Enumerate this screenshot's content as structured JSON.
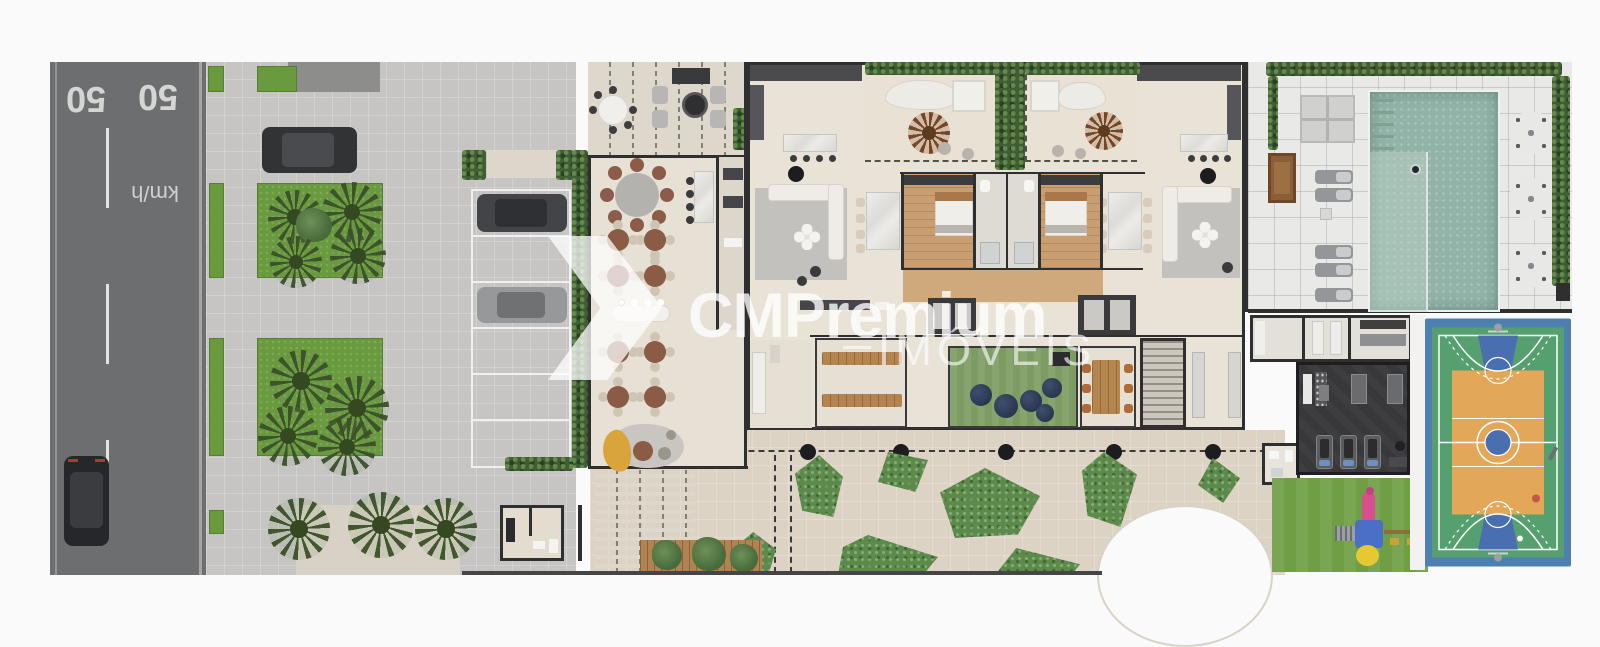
{
  "road": {
    "marks": [
      "50",
      "50"
    ],
    "unit": "km/h"
  },
  "watermark": {
    "brand": "CMPremium",
    "subtitle": "IMÓVEIS",
    "logo": "chevron-arrow-logo"
  },
  "palette": {
    "asphalt": "#6d6e70",
    "road_marking": "#d5d5d3",
    "sidewalk": "#c6c5c3",
    "grass": "#699a3e",
    "hedge": "#3f5e34",
    "building_floor": "#e7e0d5",
    "wall": "#2f2f30",
    "wood_floor": "#c99f72",
    "plaza_paving": "#ddd3c5",
    "pool_water": "#92b3a7",
    "pool_lane": "#aac5ba",
    "pool_deck": "#e9e9e7",
    "gym_floor": "#38383b",
    "kids_turf": "#7d9c63",
    "court_border_blue": "#4d80b0",
    "court_green": "#56a070",
    "court_orange": "#e3a75a",
    "court_key_blue": "#4a6fb0",
    "playground_grass": "#6f9e44",
    "slide_pink": "#d84f8f",
    "platform_blue": "#4a6fc4",
    "sofa_yellow": "#d9a43b",
    "watermark_white": "rgba(255,255,255,0.75)"
  }
}
